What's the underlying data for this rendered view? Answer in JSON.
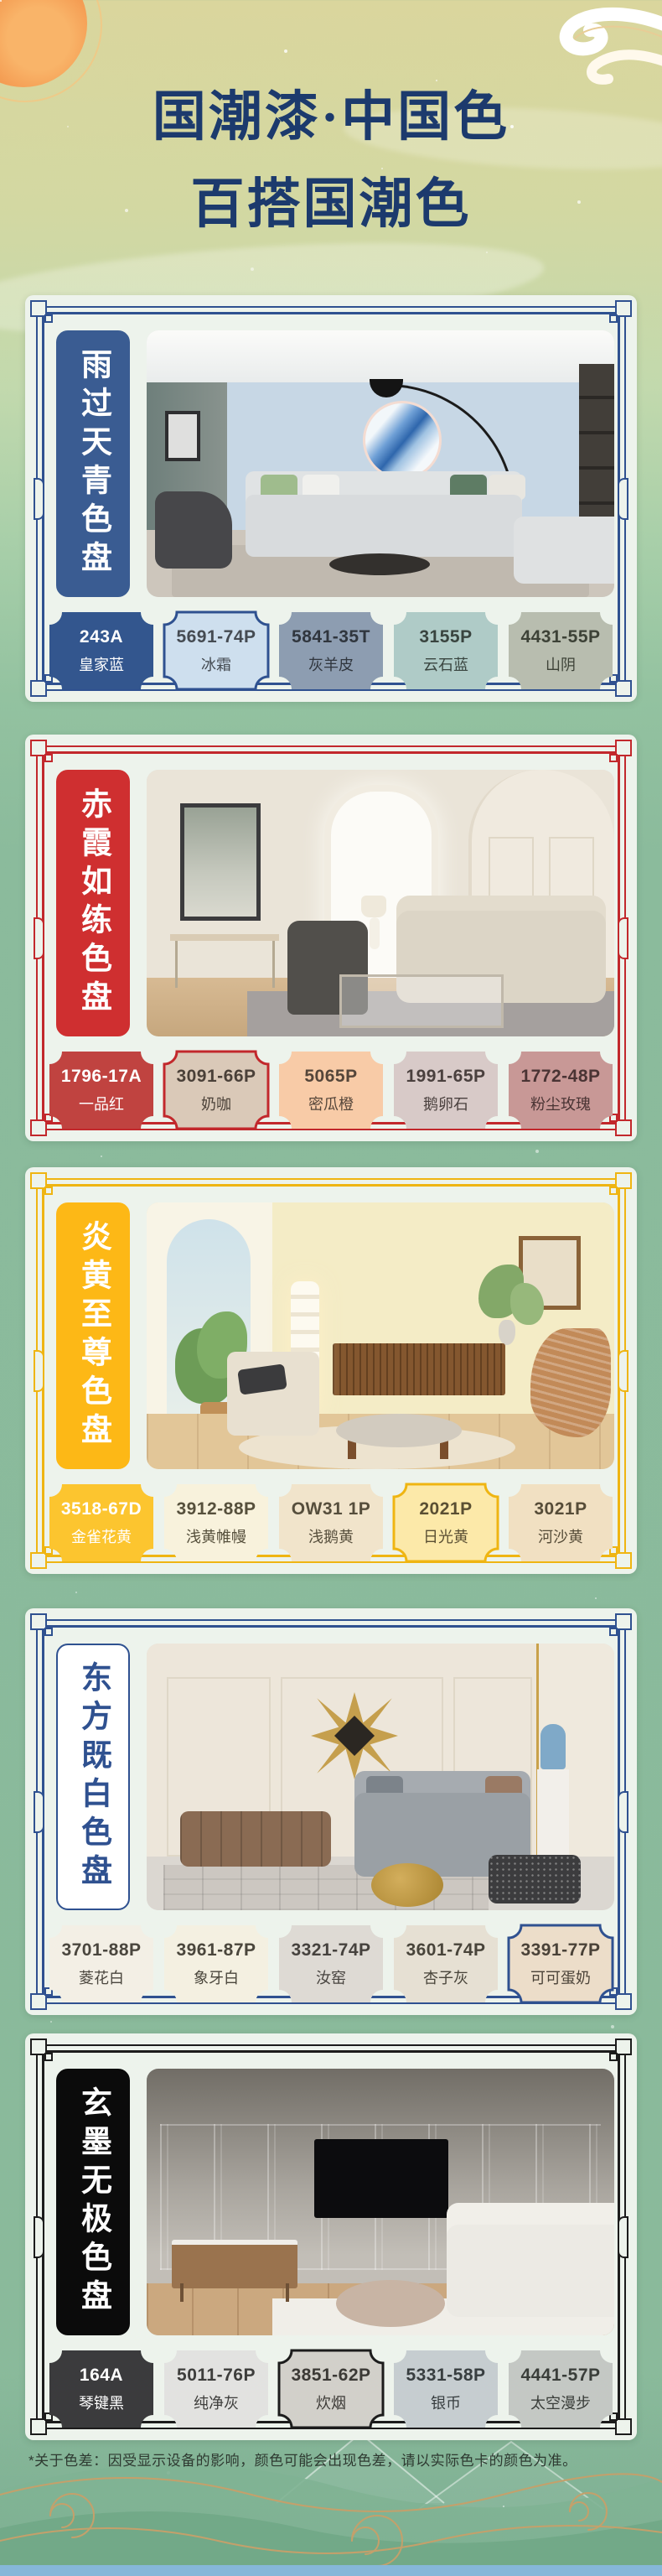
{
  "poster": {
    "title_line1": "国潮漆·中国色",
    "title_line2": "百搭国潮色",
    "footnote": "*关于色差：因受显示设备的影响，颜色可能会出现色差，请以实际色卡的颜色为准。"
  },
  "palettes": [
    {
      "name": "雨过天青色盘",
      "accent": "#2F5190",
      "banner_bg": "#3A5C92",
      "banner_text": "#FFFFFF",
      "banner_border": "#3A5C92",
      "swatches": [
        {
          "code": "243A",
          "name": "皇家蓝",
          "bg": "#33568E",
          "text": "#FFFFFF"
        },
        {
          "code": "5691-74P",
          "name": "冰霜",
          "bg": "#CEDFEE",
          "text": "#454B52",
          "border": "#2F5190"
        },
        {
          "code": "5841-35T",
          "name": "灰羊皮",
          "bg": "#8D9DB1",
          "text": "#30363E"
        },
        {
          "code": "3155P",
          "name": "云石蓝",
          "bg": "#AFCBC7",
          "text": "#39443F"
        },
        {
          "code": "4431-55P",
          "name": "山阴",
          "bg": "#B8BDAF",
          "text": "#3D4237"
        }
      ]
    },
    {
      "name": "赤霞如练色盘",
      "accent": "#C2282C",
      "banner_bg": "#CF2F30",
      "banner_text": "#FFFFFF",
      "banner_border": "#CF2F30",
      "swatches": [
        {
          "code": "1796-17A",
          "name": "一品红",
          "bg": "#C04340",
          "text": "#FFFFFF"
        },
        {
          "code": "3091-66P",
          "name": "奶咖",
          "bg": "#DAC9B8",
          "text": "#4A4038",
          "border": "#C2282C"
        },
        {
          "code": "5065P",
          "name": "密瓜橙",
          "bg": "#F8CBA7",
          "text": "#55463A"
        },
        {
          "code": "1991-65P",
          "name": "鹅卵石",
          "bg": "#D8CAC8",
          "text": "#4A403E"
        },
        {
          "code": "1772-48P",
          "name": "粉尘玫瑰",
          "bg": "#C89896",
          "text": "#4A3434"
        }
      ]
    },
    {
      "name": "炎黄至尊色盘",
      "accent": "#EFB512",
      "banner_bg": "#FDB816",
      "banner_text": "#FFFFFF",
      "banner_border": "#FDB816",
      "swatches": [
        {
          "code": "3518-67D",
          "name": "金雀花黄",
          "bg": "#FCC52F",
          "text": "#FFFFFF"
        },
        {
          "code": "3912-88P",
          "name": "浅黄帷幔",
          "bg": "#F8F2DC",
          "text": "#56503C"
        },
        {
          "code": "OW31 1P",
          "name": "浅鹅黄",
          "bg": "#F1E4CB",
          "text": "#564E3C"
        },
        {
          "code": "2021P",
          "name": "日光黄",
          "bg": "#FCE9A9",
          "text": "#5A4F33",
          "border": "#EFB512"
        },
        {
          "code": "3021P",
          "name": "河沙黄",
          "bg": "#F1E0C2",
          "text": "#564C38"
        }
      ]
    },
    {
      "name": "东方既白色盘",
      "accent": "#2F5190",
      "banner_bg": "#FFFFFF",
      "banner_text": "#2F5190",
      "banner_border": "#2F5190",
      "swatches": [
        {
          "code": "3701-88P",
          "name": "菱花白",
          "bg": "#F3EFE5",
          "text": "#4A463E"
        },
        {
          "code": "3961-87P",
          "name": "象牙白",
          "bg": "#F4F0E1",
          "text": "#4A463C"
        },
        {
          "code": "3321-74P",
          "name": "汝窑",
          "bg": "#DEDAD4",
          "text": "#46423E"
        },
        {
          "code": "3601-74P",
          "name": "杏子灰",
          "bg": "#E6E0D3",
          "text": "#48443A"
        },
        {
          "code": "3391-77P",
          "name": "可可蛋奶",
          "bg": "#ECDDC9",
          "text": "#4A4238",
          "border": "#2F5190"
        }
      ]
    },
    {
      "name": "玄墨无极色盘",
      "accent": "#1C1C1C",
      "banner_bg": "#0B0B0B",
      "banner_text": "#FFFFFF",
      "banner_border": "#0B0B0B",
      "swatches": [
        {
          "code": "164A",
          "name": "琴键黑",
          "bg": "#3B3B3D",
          "text": "#FFFFFF"
        },
        {
          "code": "5011-76P",
          "name": "纯净灰",
          "bg": "#E2E2E0",
          "text": "#3E3E3C"
        },
        {
          "code": "3851-62P",
          "name": "炊烟",
          "bg": "#D2D0CA",
          "text": "#3C3A36",
          "border": "#1C1C1C"
        },
        {
          "code": "5331-58P",
          "name": "银币",
          "bg": "#C6CDD0",
          "text": "#383E40"
        },
        {
          "code": "4441-57P",
          "name": "太空漫步",
          "bg": "#C4C8C4",
          "text": "#3A3E3A"
        }
      ]
    }
  ]
}
